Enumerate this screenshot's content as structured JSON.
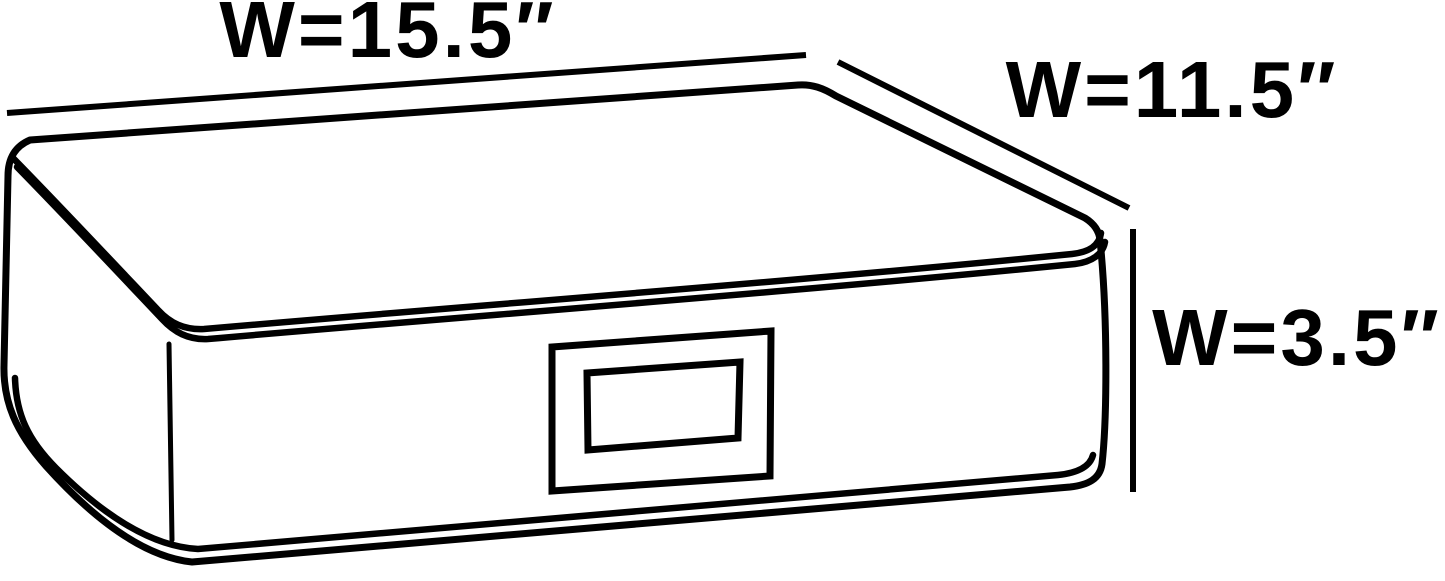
{
  "diagram": {
    "kind": "product-dimension-diagram",
    "subject": "underbed storage box with label window",
    "dimensions": {
      "width": {
        "label": "W=15.5″",
        "inches": 15.5
      },
      "depth": {
        "label": "W=11.5″",
        "inches": 11.5
      },
      "height": {
        "label": "W=3.5″",
        "inches": 3.5
      }
    },
    "colors": {
      "background": "#ffffff",
      "box_fill": "#bcbcbc",
      "outline": "#000000",
      "label_window_fill": "#ffffff"
    }
  }
}
